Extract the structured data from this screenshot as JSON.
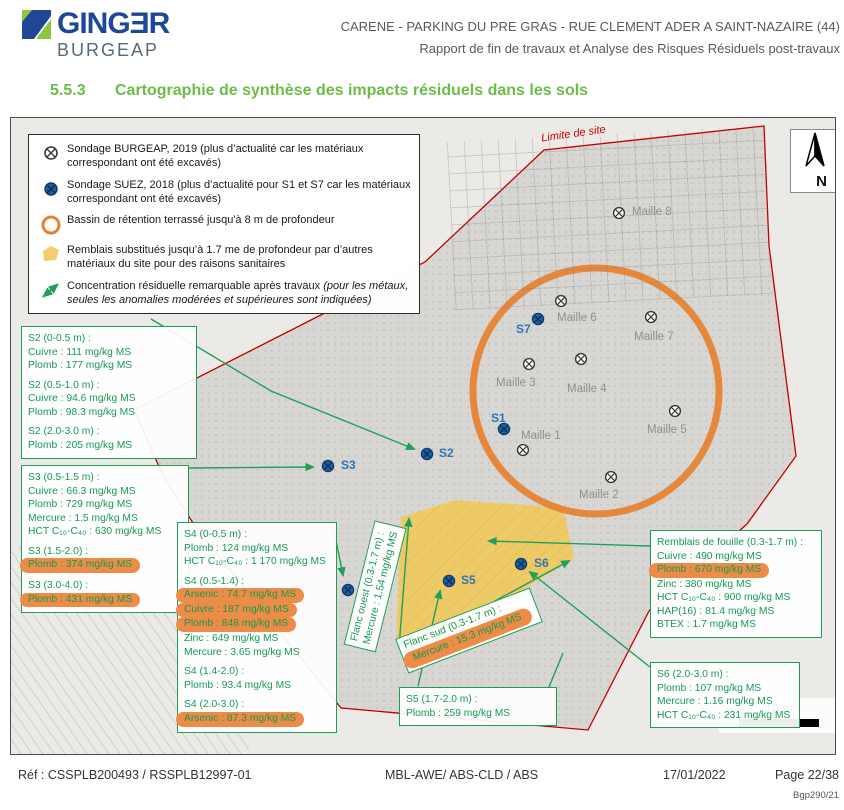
{
  "header": {
    "logo": {
      "brand": "GINGƎR",
      "sub": "BURGEAP"
    },
    "title_line1": "CARENE - PARKING DU PRE GRAS - RUE CLEMENT ADER A SAINT-NAZAIRE (44)",
    "title_line2": "Rapport de fin de travaux et Analyse des Risques Résiduels post-travaux"
  },
  "section": {
    "number": "5.5.3",
    "title": "Cartographie de synthèse des impacts résiduels dans les sols"
  },
  "colors": {
    "accent_green": "#169a52",
    "highlight_orange": "#ed8c46",
    "basin_orange": "#e6812f",
    "backfill_yellow": "#f0ca62",
    "boundary_red": "#c00000",
    "suez_blue": "#1d5fa3",
    "heading_green": "#6cbd45",
    "logo_blue": "#1f4796"
  },
  "map": {
    "limit_label": "Limite de site",
    "north_label": "N",
    "scale_label": "10 m",
    "legend": {
      "items": [
        {
          "icon": "burgeap-marker",
          "text": "Sondage BURGEAP, 2019 (plus d’actualité car les matériaux correspondant ont été excavés)"
        },
        {
          "icon": "suez-marker",
          "text": "Sondage SUEZ, 2018 (plus d’actualité pour S1 et S7 car les matériaux correspondant ont été excavés)"
        },
        {
          "icon": "basin-circle",
          "text": "Bassin de rétention terrassé jusqu'à 8 m de profondeur"
        },
        {
          "icon": "backfill-polygon",
          "text": "Remblais substitués jusqu’à 1.7 me de profondeur par d’autres matériaux du site pour des raisons sanitaires"
        },
        {
          "icon": "green-arrow",
          "text": "Concentration résiduelle remarquable après travaux ",
          "note": "(pour les métaux, seules les anomalies modérées et supérieures sont indiquées)"
        }
      ]
    },
    "boreholes": [
      {
        "id": "S1",
        "x": 493,
        "y": 311,
        "label": "S1",
        "lx": 480,
        "ly": 293
      },
      {
        "id": "S2",
        "x": 416,
        "y": 336,
        "label": "S2",
        "lx": 428,
        "ly": 328
      },
      {
        "id": "S3",
        "x": 317,
        "y": 348,
        "label": "S3",
        "lx": 330,
        "ly": 340
      },
      {
        "id": "S4",
        "x": 337,
        "y": 472
      },
      {
        "id": "S5",
        "x": 438,
        "y": 463,
        "label": "S5",
        "lx": 450,
        "ly": 455
      },
      {
        "id": "S6",
        "x": 510,
        "y": 446,
        "label": "S6",
        "lx": 523,
        "ly": 438
      },
      {
        "id": "S7",
        "x": 527,
        "y": 201,
        "label": "S7",
        "lx": 505,
        "ly": 204
      }
    ],
    "grid_points": [
      {
        "id": "Maille 1",
        "x": 512,
        "y": 332,
        "lx": 510,
        "ly": 312
      },
      {
        "id": "Maille 2",
        "x": 600,
        "y": 359,
        "lx": 568,
        "ly": 371
      },
      {
        "id": "Maille 3",
        "x": 518,
        "y": 246,
        "lx": 485,
        "ly": 259
      },
      {
        "id": "Maille 4",
        "x": 570,
        "y": 241,
        "lx": 556,
        "ly": 265
      },
      {
        "id": "Maille 5",
        "x": 664,
        "y": 293,
        "lx": 636,
        "ly": 306
      },
      {
        "id": "Maille 6",
        "x": 550,
        "y": 183,
        "lx": 546,
        "ly": 194
      },
      {
        "id": "Maille 7",
        "x": 640,
        "y": 199,
        "lx": 623,
        "ly": 213
      },
      {
        "id": "Maille 8",
        "x": 608,
        "y": 95,
        "lx": 621,
        "ly": 88
      }
    ],
    "data_boxes": [
      {
        "id": "s2",
        "x": 10,
        "y": 208,
        "w": 176,
        "sections": [
          {
            "h": "S2 (0-0.5 m) :",
            "rows": [
              {
                "t": "Cuivre : 111 mg/kg MS"
              },
              {
                "t": "Plomb : 177 mg/kg MS"
              }
            ]
          },
          {
            "h": "S2 (0.5-1.0 m) :",
            "rows": [
              {
                "t": "Cuivre : 94.6 mg/kg MS"
              },
              {
                "t": "Plomb : 98.3 mg/kg MS"
              }
            ]
          },
          {
            "h": "S2 (2.0-3.0 m) :",
            "rows": [
              {
                "t": "Plomb : 205 mg/kg MS"
              }
            ]
          }
        ]
      },
      {
        "id": "s3",
        "x": 10,
        "y": 347,
        "w": 168,
        "sections": [
          {
            "h": "S3 (0.5-1.5 m) :",
            "rows": [
              {
                "t": "Cuivre : 66.3 mg/kg MS"
              },
              {
                "t": "Plomb : 729 mg/kg MS"
              },
              {
                "t": "Mercure : 1.5 mg/kg MS"
              },
              {
                "t": "HCT C₁₀-C₄₀ : 630 mg/kg MS"
              }
            ]
          },
          {
            "h": "S3 (1.5-2.0) :",
            "rows": [
              {
                "t": "Plomb : 374 mg/kg MS",
                "hl": true
              }
            ]
          },
          {
            "h": "S3 (3.0-4.0) :",
            "rows": [
              {
                "t": "Plomb : 431 mg/kg MS",
                "hl": true
              }
            ]
          }
        ]
      },
      {
        "id": "s4",
        "x": 166,
        "y": 404,
        "w": 160,
        "sections": [
          {
            "h": "S4 (0-0.5 m) :",
            "rows": [
              {
                "t": "Plomb : 124 mg/kg MS"
              },
              {
                "t": "HCT C₁₀-C₄₀ : 1 170 mg/kg MS"
              }
            ]
          },
          {
            "h": "S4 (0.5-1.4) :",
            "rows": [
              {
                "t": "Arsenic : 74.7 mg/kg MS",
                "hl": true
              },
              {
                "t": "Cuivre : 187 mg/kg MS",
                "hl": true
              },
              {
                "t": "Plomb : 848 mg/kg MS",
                "hl": true
              },
              {
                "t": "Zinc : 649 mg/kg MS"
              },
              {
                "t": "Mercure : 3.65 mg/kg MS"
              }
            ]
          },
          {
            "h": "S4 (1.4-2.0) :",
            "rows": [
              {
                "t": "Plomb : 93.4 mg/kg MS"
              }
            ]
          },
          {
            "h": "S4 (2.0-3.0) :",
            "rows": [
              {
                "t": "Arsenic : 87.3 mg/kg MS",
                "hl": true
              }
            ]
          }
        ]
      },
      {
        "id": "s5",
        "x": 388,
        "y": 569,
        "w": 158,
        "sections": [
          {
            "h": "S5 (1.7-2.0 m) :",
            "rows": [
              {
                "t": "Plomb : 259 mg/kg MS"
              }
            ]
          }
        ]
      },
      {
        "id": "remblais",
        "x": 639,
        "y": 412,
        "w": 172,
        "sections": [
          {
            "h": "Remblais de fouille (0.3-1.7 m) :",
            "rows": [
              {
                "t": "Cuivre : 490 mg/kg MS"
              },
              {
                "t": "Plomb : 670 mg/kg MS",
                "hl": true
              },
              {
                "t": "Zinc : 380 mg/kg MS"
              },
              {
                "t": "HCT C₁₀-C₄₀ : 900 mg/kg MS"
              },
              {
                "t": "HAP(16) : 81.4 mg/kg MS"
              },
              {
                "t": "BTEX : 1.7 mg/kg MS"
              }
            ]
          }
        ]
      },
      {
        "id": "s6",
        "x": 639,
        "y": 544,
        "w": 150,
        "sections": [
          {
            "h": "S6 (2.0-3.0 m) :",
            "rows": [
              {
                "t": "Plomb : 107 mg/kg MS"
              },
              {
                "t": "Mercure : 1.16 mg/kg MS"
              },
              {
                "t": "HCT C₁₀-C₄₀ : 231 mg/kg MS"
              }
            ]
          }
        ]
      }
    ],
    "flank_labels": [
      {
        "id": "flanc-ouest",
        "x": 300,
        "y": 452,
        "w": 128,
        "angle": -76,
        "line1": "Flanc ouest (0.3-1.7 m) :",
        "line2": "Mercure : 1.54 mg/kg MS",
        "hl2": false
      },
      {
        "id": "flanc-sud",
        "x": 386,
        "y": 494,
        "w": 144,
        "angle": -21,
        "line1": "Flanc sud (0.3-1.7 m) :",
        "line2": "Mercure : 15.3 mg/kg MS",
        "hl2": true
      }
    ]
  },
  "footer": {
    "ref": "Réf : CSSPLB200493 / RSSPLB12997-01",
    "authors": "MBL-AWE/ ABS-CLD / ABS",
    "date": "17/01/2022",
    "page": "Page 22/38",
    "doc_code": "Bgp290/21"
  }
}
